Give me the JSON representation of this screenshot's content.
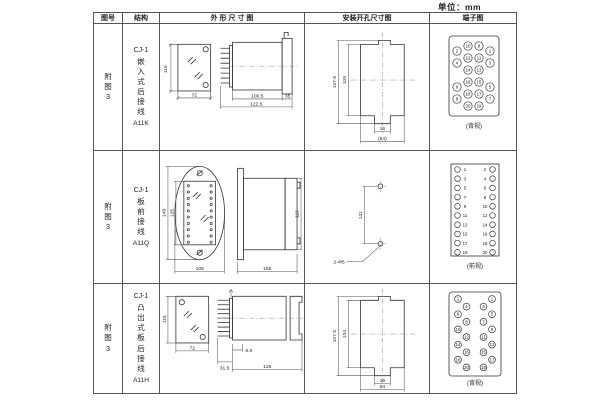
{
  "unit_label": "单位：mm",
  "header": {
    "figure": "图号",
    "structure": "结构",
    "outline": "外 形 尺 寸 图",
    "mounting": "安装开孔尺寸图",
    "terminal": "端子图"
  },
  "rows": [
    {
      "figure": "附图3",
      "model": "CJ-1",
      "structure": "嵌入式后接线",
      "code": "A11K",
      "outline": {
        "front_height": "115",
        "front_width": "72",
        "body_length": "100.5",
        "total_length": "122.5",
        "flange_depth": "35"
      },
      "mounting": {
        "outer_height": "107.5",
        "inner_height": "105",
        "slot_width": "16",
        "outer_width": "(64)"
      },
      "terminal": {
        "caption": "(背视)",
        "numbers": [
          2,
          10,
          9,
          1,
          4,
          12,
          11,
          3,
          14,
          13,
          6,
          16,
          15,
          5,
          8,
          18,
          17,
          7,
          20,
          19
        ]
      }
    },
    {
      "figure": "附图3",
      "model": "CJ-1",
      "structure": "板前接线",
      "code": "A11Q",
      "outline": {
        "outer_height": "149",
        "inner_height": "125",
        "front_width": "105",
        "side_length": "156",
        "side_height": "115"
      },
      "mounting": {
        "hole_spacing": "131",
        "hole_label": "2-Φ5"
      },
      "terminal": {
        "caption": "(前视)",
        "left_numbers": [
          1,
          3,
          5,
          7,
          9,
          11,
          13,
          15,
          17,
          19
        ],
        "right_numbers": [
          2,
          4,
          6,
          8,
          10,
          12,
          14,
          16,
          18,
          20
        ]
      }
    },
    {
      "figure": "附图3",
      "model": "CJ-1",
      "structure": "凸出式板后接线",
      "code": "A11H",
      "outline": {
        "front_height": "115",
        "front_width": "72",
        "pin_length": "31.5",
        "pin_offset": "9.5",
        "body_length": "126"
      },
      "mounting": {
        "outer_height": "107.5",
        "inner_height": "104",
        "slot_width": "16",
        "outer_width": "64"
      },
      "terminal": {
        "caption": "(背视)",
        "left_numbers": [
          2,
          4,
          6,
          8,
          10,
          12,
          14,
          16,
          18,
          20
        ],
        "right_numbers": [
          1,
          3,
          5,
          7,
          9,
          11,
          13,
          15,
          17,
          19
        ]
      }
    }
  ]
}
